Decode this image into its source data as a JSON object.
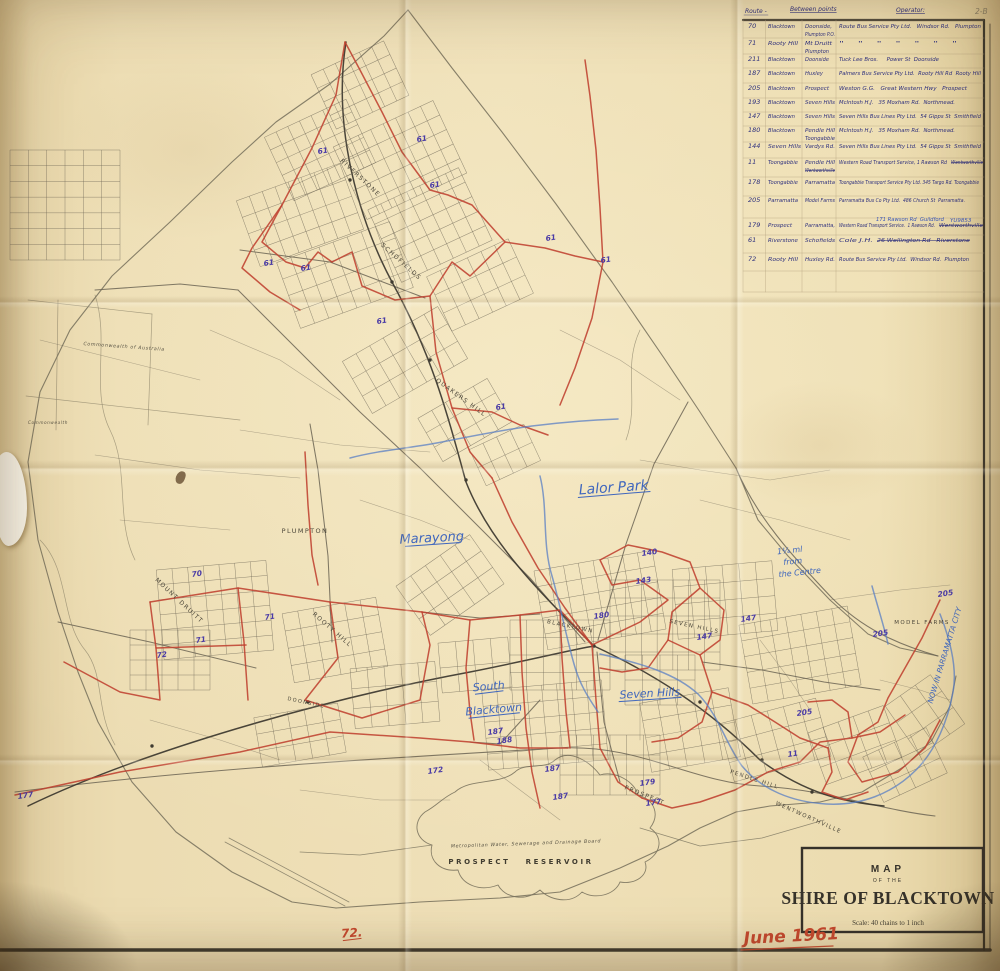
{
  "sheet": {
    "corner_note": "2-B",
    "date_note": "June 1961"
  },
  "title_block": {
    "map_word": "MAP",
    "of_the": "OF THE",
    "title": "SHIRE OF BLACKTOWN",
    "scale": "Scale: 40 chains to 1 inch"
  },
  "route_table": {
    "header": {
      "route": "Route -",
      "between": "Between points",
      "operator": "Operator:"
    },
    "rows": [
      {
        "route": "70",
        "from": "Blacktown",
        "to": "Doonside,",
        "to2": "Plumpton P.O.",
        "operator": "Route Bus Service Pty Ltd.   Windsor Rd.   Plumpton"
      },
      {
        "route": "71",
        "from": "Rooty Hill",
        "to": "Mt Druitt",
        "to2": "Plumpton",
        "operator": "\"    \"    \"    \"    \"    \"    \""
      },
      {
        "route": "211",
        "from": "Blacktown",
        "to": "Doonside",
        "operator": "Tuck Lee Bros.     Power St  Doonside"
      },
      {
        "route": "187",
        "from": "Blacktown",
        "to": "Huxley",
        "operator": "Palmers Bus Service Pty Ltd.  Rooty Hill Rd  Rooty Hill"
      },
      {
        "route": "205",
        "from": "Blacktown",
        "to": "Prospect",
        "operator": "Weston G.G.   Great Western Hwy   Prospect"
      },
      {
        "route": "193",
        "from": "Blacktown",
        "to": "Seven Hills",
        "operator": "McIntosh H.J.   35 Moxham Rd.  Northmead."
      },
      {
        "route": "147",
        "from": "Blacktown",
        "to": "Seven Hills",
        "operator": "Seven Hills Bus Lines Pty Ltd.  54 Gipps St  Smithfield"
      },
      {
        "route": "180",
        "from": "Blacktown",
        "to": "Pendle Hill",
        "to2": "Toongabbie",
        "operator": "McIntosh H.J.   35 Moxham Rd.  Northmead."
      },
      {
        "route": "144",
        "from": "Seven Hills",
        "to": "Vardys Rd.",
        "operator": "Seven Hills Bus Lines Pty Ltd.  54 Gipps St  Smithfield"
      },
      {
        "route": "11",
        "from": "Toongabbie",
        "to": "Pendle Hill",
        "to2": "Wentworthville",
        "to2_struck": true,
        "operator": "Western Road Transport Service, 1 Rawson Rd",
        "operator_struck": "Wentworthville"
      },
      {
        "route": "178",
        "from": "Toongabbie",
        "to": "Parramatta",
        "operator": "Toongabbie Transport Service Pty Ltd. 345 Targo Rd. Toongabbie"
      },
      {
        "route": "205",
        "from": "Parramatta",
        "to": "Model Farms",
        "operator": "Parramatta Bus Co Pty Ltd.  486 Church St  Parramatta."
      },
      {
        "route": "179",
        "from": "Prospect",
        "to": "Parramatta,",
        "operator": "Western Road Transport Service.  1 Rawson Rd.",
        "operator_struck": "Wentworthville",
        "note": "171 Rawson Rd  Guildford",
        "note2": "YU9853"
      },
      {
        "route": "61",
        "from": "Riverstone",
        "to": "Schofields",
        "operator": "Cole J.H.",
        "operator_struck": "26 Wellington Rd   Riverstone"
      },
      {
        "route": "72",
        "from": "Rooty Hill",
        "to": "Huxley Rd.",
        "operator": "Route Bus Service Pty Ltd.  Windsor Rd.  Plumpton"
      }
    ]
  },
  "map": {
    "printed_labels": [
      {
        "id": "riverstone",
        "text": "RIVERSTONE"
      },
      {
        "id": "schofields",
        "text": "SCHOFIELDS"
      },
      {
        "id": "quakers-hill",
        "text": "QUAKERS HILL"
      },
      {
        "id": "plumpton",
        "text": "PLUMPTON"
      },
      {
        "id": "mount-druitt",
        "text": "MOUNT DRUITT"
      },
      {
        "id": "rooty-hill",
        "text": "ROOTY HILL"
      },
      {
        "id": "blacktown",
        "text": "BLACKTOWN"
      },
      {
        "id": "seven-hills",
        "text": "SEVEN HILLS"
      },
      {
        "id": "doonside",
        "text": "DOONSIDE"
      },
      {
        "id": "prospect",
        "text": "PROSPECT"
      },
      {
        "id": "pendle-hill",
        "text": "PENDLE HILL"
      },
      {
        "id": "wentworthville",
        "text": "WENTWORTHVILLE"
      },
      {
        "id": "model-farms",
        "text": "MODEL FARMS"
      },
      {
        "id": "prospect-reservoir",
        "text": "PROSPECT   RESERVOIR"
      },
      {
        "id": "water-board",
        "text": "Metropolitan Water, Sewerage and Drainage Board"
      },
      {
        "id": "commonwealth",
        "text": "Commonwealth of Australia"
      },
      {
        "id": "commonwealth-2",
        "text": "Commonwealth"
      }
    ],
    "handwritten_labels": [
      {
        "id": "lalor-park",
        "text": "Lalor Park"
      },
      {
        "id": "marayong",
        "text": "Marayong"
      },
      {
        "id": "south",
        "text": "South"
      },
      {
        "id": "blacktown-hw",
        "text": "Blacktown"
      },
      {
        "id": "seven-hills-hw",
        "text": "Seven Hills"
      },
      {
        "id": "parramatta-city",
        "text": "NOW IN PARRAMATTA CITY"
      },
      {
        "id": "centre-note-1",
        "text": "1¼ ml"
      },
      {
        "id": "centre-note-2",
        "text": "from"
      },
      {
        "id": "centre-note-3",
        "text": "the Centre"
      },
      {
        "id": "red-72",
        "text": "72."
      }
    ],
    "route_number_marks": [
      "61",
      "61",
      "61",
      "61",
      "61",
      "61",
      "61",
      "61",
      "61",
      "70",
      "71",
      "72",
      "71",
      "187",
      "188",
      "187",
      "187",
      "172",
      "177",
      "140",
      "143",
      "180",
      "147",
      "147",
      "205",
      "205",
      "205",
      "179",
      "177",
      "11"
    ]
  },
  "colors": {
    "paper": "#ecdcb0",
    "route_red": "#bf4130",
    "ink_blue": "#2d2f7d",
    "ballpoint_blue": "#3f66bd",
    "mark_purple": "#4a3ba6",
    "pencil_blue": "#5a7fc4",
    "line_gray": "#6b6454",
    "date_red": "#c5492f"
  }
}
